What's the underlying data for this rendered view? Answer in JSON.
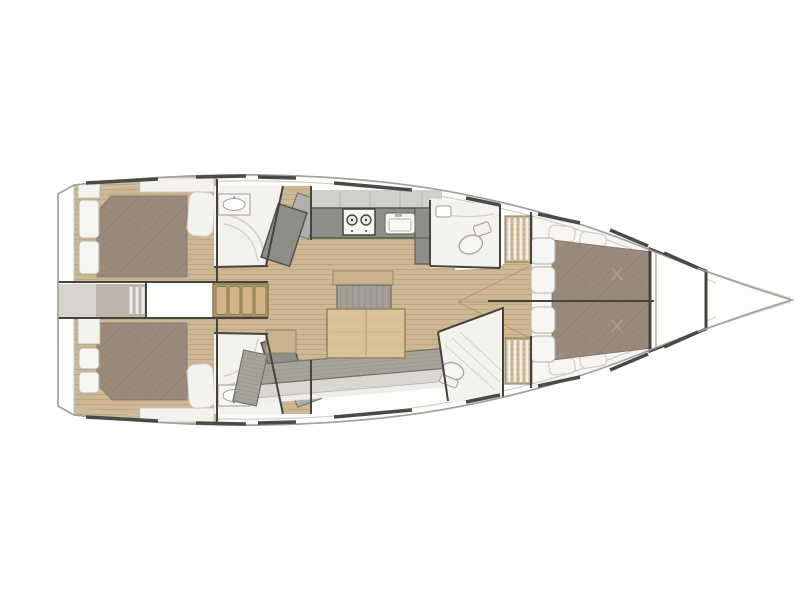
{
  "diagram": {
    "type": "sailing-yacht-interior-layout-plan",
    "view": "top-down",
    "orientation": "bow-right",
    "cabin_count": 3,
    "wet_room_count": 4,
    "rooms": [
      {
        "id": "aft-cabin-port",
        "kind": "double-berth-cabin"
      },
      {
        "id": "aft-cabin-starboard",
        "kind": "double-berth-cabin"
      },
      {
        "id": "aft-head-port",
        "kind": "head-with-sink-and-shower"
      },
      {
        "id": "aft-head-starboard",
        "kind": "head-with-sink-and-shower"
      },
      {
        "id": "companionway",
        "kind": "steps-and-engine-box"
      },
      {
        "id": "galley",
        "kind": "galley-stove-2-burners-and-sink"
      },
      {
        "id": "salon",
        "kind": "settee-table-ottoman"
      },
      {
        "id": "forward-head-port",
        "kind": "head-with-toilet"
      },
      {
        "id": "forward-shower-starboard",
        "kind": "shower-room"
      },
      {
        "id": "forward-cabin",
        "kind": "island-double-berth"
      },
      {
        "id": "anchor-locker",
        "kind": "locker"
      },
      {
        "id": "bow",
        "kind": "bowsprit"
      }
    ],
    "furniture": [
      "double-berth",
      "pillows",
      "companionway-steps",
      "engine-box",
      "stove-2-burner",
      "galley-sink",
      "dining-table",
      "ottoman",
      "settee",
      "side-table",
      "toilet",
      "washbasin",
      "anchor-locker"
    ]
  },
  "colors": {
    "bg": "#ffffff",
    "deckWhite": "#fdfdfb",
    "hullStroke": "#a2a09a",
    "innerLine": "#c9c7c0",
    "dark": "#45443e",
    "dash": "#4b4a45",
    "roomWhite": "#f3f2ed",
    "furnWhite": "#f7f6f2",
    "wood": "#cdb795",
    "woodLine": "#b59c74",
    "seam": "#b29a74",
    "stepBase": "#b4986c",
    "stepTread": "#d2b586",
    "stepStroke": "#8a7a50",
    "tableWood": "#d8c297",
    "tableStroke": "#96845f",
    "barWood": "#c9b28c",
    "mattress": "#998a7c",
    "mattressLine": "#8d7e70",
    "mattressStroke": "#7e7265",
    "pillow": "#f6f5f1",
    "pillowStroke": "#b7b3aa",
    "counter": "#8e8d89",
    "counterDark": "#55534d",
    "upperCab": "#d0cfcb",
    "cabDivider": "#b5b3ae",
    "sofa": "#a6a399",
    "sofaLine": "#94917f",
    "sofaFront": "#d9d7cf",
    "sofaStroke": "#73716b",
    "sofaEdge": "#efede7",
    "ottoman": "#a3a098",
    "ottomanLine": "#8f8c84",
    "lockerDark": "#8e8d88",
    "lockerLight": "#b0afab",
    "cockpit": "#bdb7ab",
    "strip": "#d6d3cb",
    "sketch": "#d2d0c9",
    "fixtureStroke": "#a09d94",
    "bowFaint": "#d8d6d0",
    "wardrobeStroke": "#ccc8be"
  }
}
